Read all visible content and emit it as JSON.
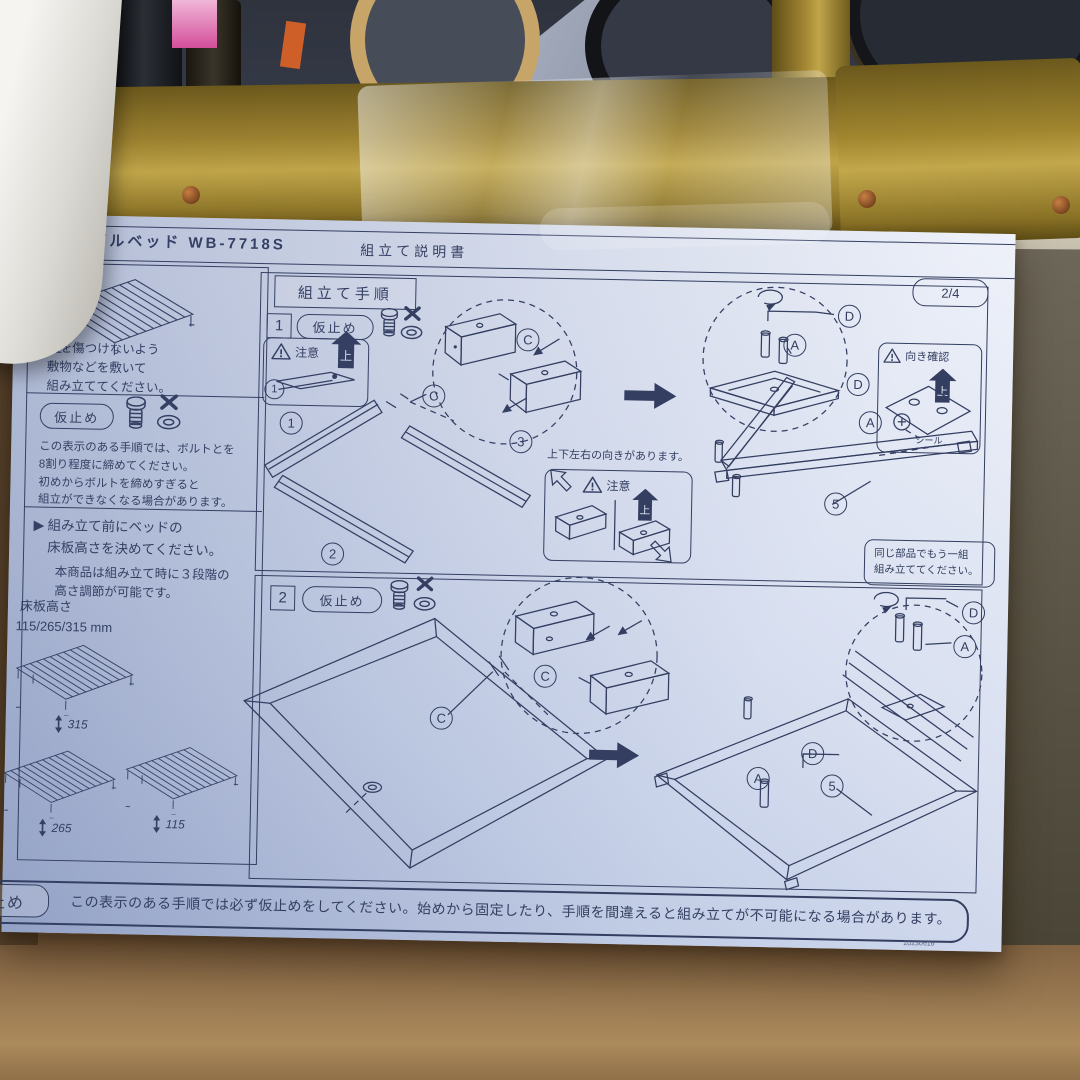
{
  "scene": {
    "colors": {
      "cardboard": "#8a6b49",
      "paper_highlight": "#eef1f9",
      "paper_shadow": "#9fadd0",
      "ink": "#333e60",
      "gold_frame": "#a2862f",
      "shelf_board": "#d9d2c0",
      "background_dark": "#363b46"
    },
    "icons": {
      "warning": "warning-triangle",
      "bolt": "bolt",
      "washer": "washer",
      "cross": "x-mark",
      "up_arrow": "up-arrow",
      "rotate": "rotate-arrow",
      "hex_key": "hex-key",
      "updown_arrow": "up-down-arrow"
    }
  },
  "document": {
    "header": {
      "product": "シングルベッド WB-7718S",
      "doc_title": "組立て説明書",
      "page": "2/4"
    },
    "sidebar": {
      "floor_note": "床を傷つけないよう\n敷物などを敷いて\n組み立ててください。",
      "karidome_label": "仮止め",
      "karidome_note": "この表示のある手順では、ボルトとを\n8割り程度に締めてください。\n初めからボルトを締めすぎると\n組立ができなくなる場合があります。",
      "height_marker": "▶",
      "height_heading": "組み立て前にベッドの\n床板高さを決めてください。",
      "height_sub": "本商品は組み立て時に３段階の\n高さ調節が可能です。",
      "floor_height_label": "床板高さ",
      "floor_height_values": "115/265/315 mm",
      "height_options": {
        "high": "315",
        "mid": "265",
        "low": "115"
      }
    },
    "procedure_title": "組立て手順",
    "step1": {
      "number": "1",
      "karidome_label": "仮止め",
      "caution_label": "注意",
      "up_label": "上",
      "orientation_note": "上下左右の向きがあります。",
      "orientation_caution_label": "注意",
      "direction_check_label": "向き確認",
      "seal_label": "シール",
      "duplicate_note": "同じ部品でもう一組\n組み立ててください。",
      "parts": {
        "p1": "1",
        "p2": "2",
        "p3": "3",
        "p5": "5",
        "A": "A",
        "C": "C",
        "D": "D"
      }
    },
    "step2": {
      "number": "2",
      "karidome_label": "仮止め",
      "parts": {
        "p5": "5",
        "A": "A",
        "C": "C",
        "D": "D"
      }
    },
    "footer": {
      "label": "仮止め",
      "text": "この表示のある手順では必ず仮止めをしてください。始めから固定したり、手順を間違えると組み立てが不可能になる場合があります。",
      "code": "20230616"
    }
  }
}
